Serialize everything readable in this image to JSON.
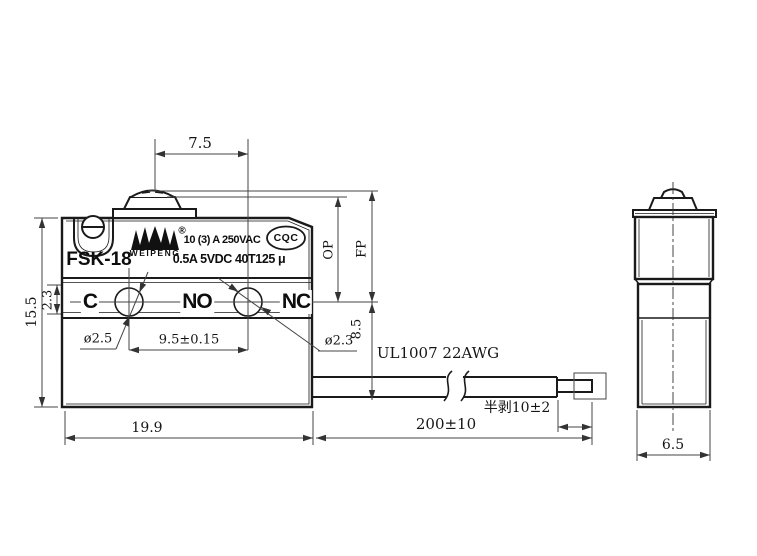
{
  "front_view": {
    "model": "FSK-18",
    "brand_initial": "W",
    "brand": "WEIPENG",
    "registered": "®",
    "rating_line1": "10 (3) A  250VAC",
    "rating_line2": "0.5A 5VDC  40T125 μ",
    "certification": "CQC",
    "terminal_common": "C",
    "terminal_normally_open": "NO",
    "terminal_normally_closed": "NC"
  },
  "wire": {
    "spec": "UL1007 22AWG",
    "length": "200±10",
    "strip_note": "半剥10±2"
  },
  "dims": {
    "plunger_to_hole": "7.5",
    "operating_position": "OP",
    "free_position": "FP",
    "body_height": "15.5",
    "strip_band_height": "2.3",
    "hole_dia_left": "ø2.5",
    "hole_dia_right": "ø2.3",
    "hole_pitch": "9.5±0.15",
    "body_width": "19.9",
    "wire_exit_height": "8.5",
    "side_width": "6.5"
  },
  "colors": {
    "background": "#ffffff",
    "part_line": "#1a1a1a",
    "dim_line": "#444444",
    "text": "#111111"
  }
}
